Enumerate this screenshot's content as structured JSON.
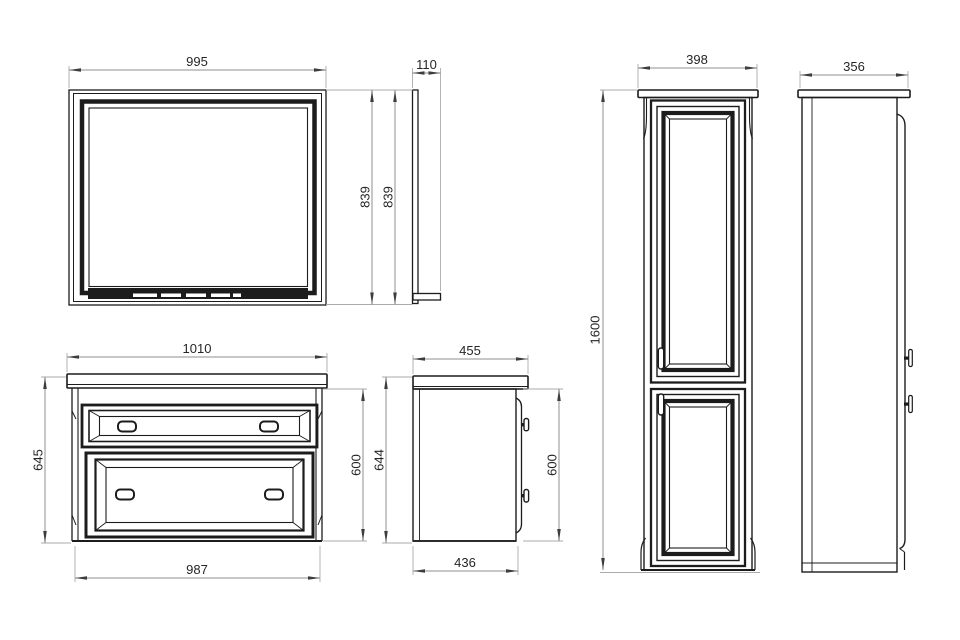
{
  "colors": {
    "background": "#ffffff",
    "object_line": "#1c1c1c",
    "panel_fill": "#ffffff",
    "dim_line": "#8f8f8f",
    "ext_line": "#ababab",
    "arrow_color": "#3d3d3d",
    "dim_text": "#262626"
  },
  "drawing": {
    "type": "orthographic furniture dimension drawing",
    "pieces": [
      "mirror",
      "vanity cabinet",
      "tall side cabinet"
    ]
  },
  "views": {
    "mirror_front": {
      "width_label": "995",
      "height_label": "839"
    },
    "mirror_side": {
      "depth_label": "110",
      "height_label": "839"
    },
    "vanity_front": {
      "top_width_label": "1010",
      "height_label": "645",
      "body_width_label": "987",
      "body_height_label": "600"
    },
    "vanity_side": {
      "top_depth_label": "455",
      "height_label": "644",
      "body_height_label": "600",
      "body_depth_label": "436"
    },
    "cabinet_front": {
      "width_label": "398",
      "height_label": "1600"
    },
    "cabinet_side": {
      "depth_label": "356"
    }
  }
}
